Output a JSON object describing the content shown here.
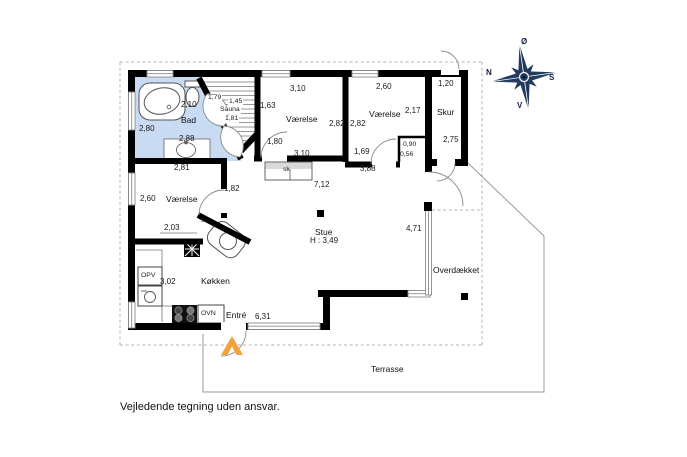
{
  "footer": {
    "disclaimer": "Vejledende tegning uden ansvar."
  },
  "compass": {
    "north": "N",
    "south": "S",
    "west": "V",
    "east": "Ø"
  },
  "colors": {
    "bathroom_fill": "#c8dbf3",
    "entrance_arrow": "#f2a33c",
    "compass": "#223a5e",
    "wall": "#000000"
  },
  "plan": {
    "bathroom": {
      "name": "Bad",
      "width": "2,10",
      "left": "2,80",
      "bottom": "2,88",
      "wall": "2,81"
    },
    "sauna": {
      "name": "Sauna",
      "dim_a": "1,79",
      "dim_b": "1,45",
      "dim_c": "1,81"
    },
    "bedroom_mid": {
      "name": "Værelse",
      "top": "3,10",
      "left": "1,63",
      "right": "2,82",
      "bottom": "3,10",
      "door": "1,80"
    },
    "bedroom_right": {
      "name": "Værelse",
      "top": "2,60",
      "right": "2,17",
      "left": "2,82",
      "inner": "1,69",
      "hall": "3,88"
    },
    "bedroom_left": {
      "name": "Værelse",
      "left": "2,60",
      "door": "1,82",
      "inner": "2,03"
    },
    "niche": {
      "width": "0,90",
      "depth": "0,56"
    },
    "shed": {
      "name": "Skur",
      "width": "1,20",
      "depth": "2,75"
    },
    "living": {
      "name": "Stue",
      "ceiling": "H : 3,49",
      "hall_length": "7,12"
    },
    "kitchen": {
      "name": "Køkken",
      "width": "3,02",
      "dishwasher": "OPV",
      "oven": "OVN"
    },
    "entry": {
      "name": "Entré",
      "width": "6,31"
    },
    "covered": {
      "name": "Overdækket",
      "window": "4,71"
    },
    "terrace": {
      "name": "Terrasse"
    },
    "closet_hall": "sk",
    "closet_kitchen": "sk"
  }
}
